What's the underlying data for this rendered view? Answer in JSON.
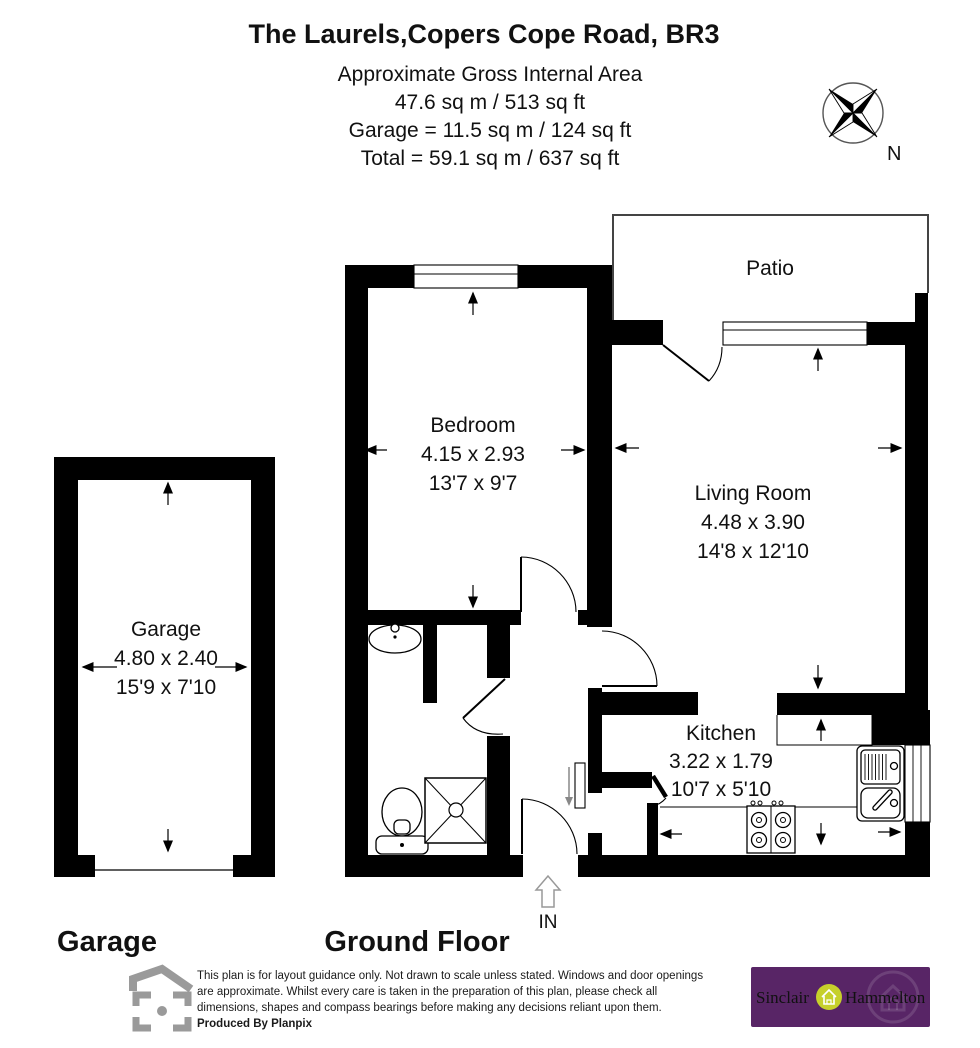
{
  "colors": {
    "wall": "#000000",
    "brand_purple": "#582566",
    "brand_gold": "#bf9a55",
    "brand_lime": "#c6d02b",
    "planpix_gray": "#9a9a9a"
  },
  "header": {
    "title": "The Laurels,Copers Cope Road, BR3",
    "subtitle": "Approximate Gross Internal Area",
    "area_line1": "47.6 sq m / 513 sq ft",
    "area_line2": "Garage = 11.5 sq m / 124 sq ft",
    "area_line3": "Total = 59.1 sq m / 637 sq ft"
  },
  "compass": {
    "north_label": "N"
  },
  "rooms": {
    "patio": {
      "name": "Patio"
    },
    "bedroom": {
      "name": "Bedroom",
      "size_metric": "4.15 x 2.93",
      "size_imperial": "13'7 x 9'7"
    },
    "living_room": {
      "name": "Living Room",
      "size_metric": "4.48 x 3.90",
      "size_imperial": "14'8 x 12'10"
    },
    "kitchen": {
      "name": "Kitchen",
      "size_metric": "3.22 x 1.79",
      "size_imperial": "10'7 x 5'10"
    },
    "garage": {
      "name": "Garage",
      "size_metric": "4.80 x 2.40",
      "size_imperial": "15'9 x 7'10"
    }
  },
  "entrance": {
    "label": "IN"
  },
  "floor_labels": {
    "garage": "Garage",
    "ground_floor": "Ground Floor"
  },
  "footer": {
    "disclaimer_lines": [
      "This plan is for layout guidance only. Not drawn to scale unless stated. Windows and door openings",
      "are approximate. Whilst every care is taken in the preparation of this plan, please check all",
      "dimensions, shapes and compass bearings before making any decisions reliant upon them."
    ],
    "produced_by": "Produced By Planpix"
  },
  "branding": {
    "name_part1": "Sinclair",
    "name_part2": "Hammelton"
  }
}
